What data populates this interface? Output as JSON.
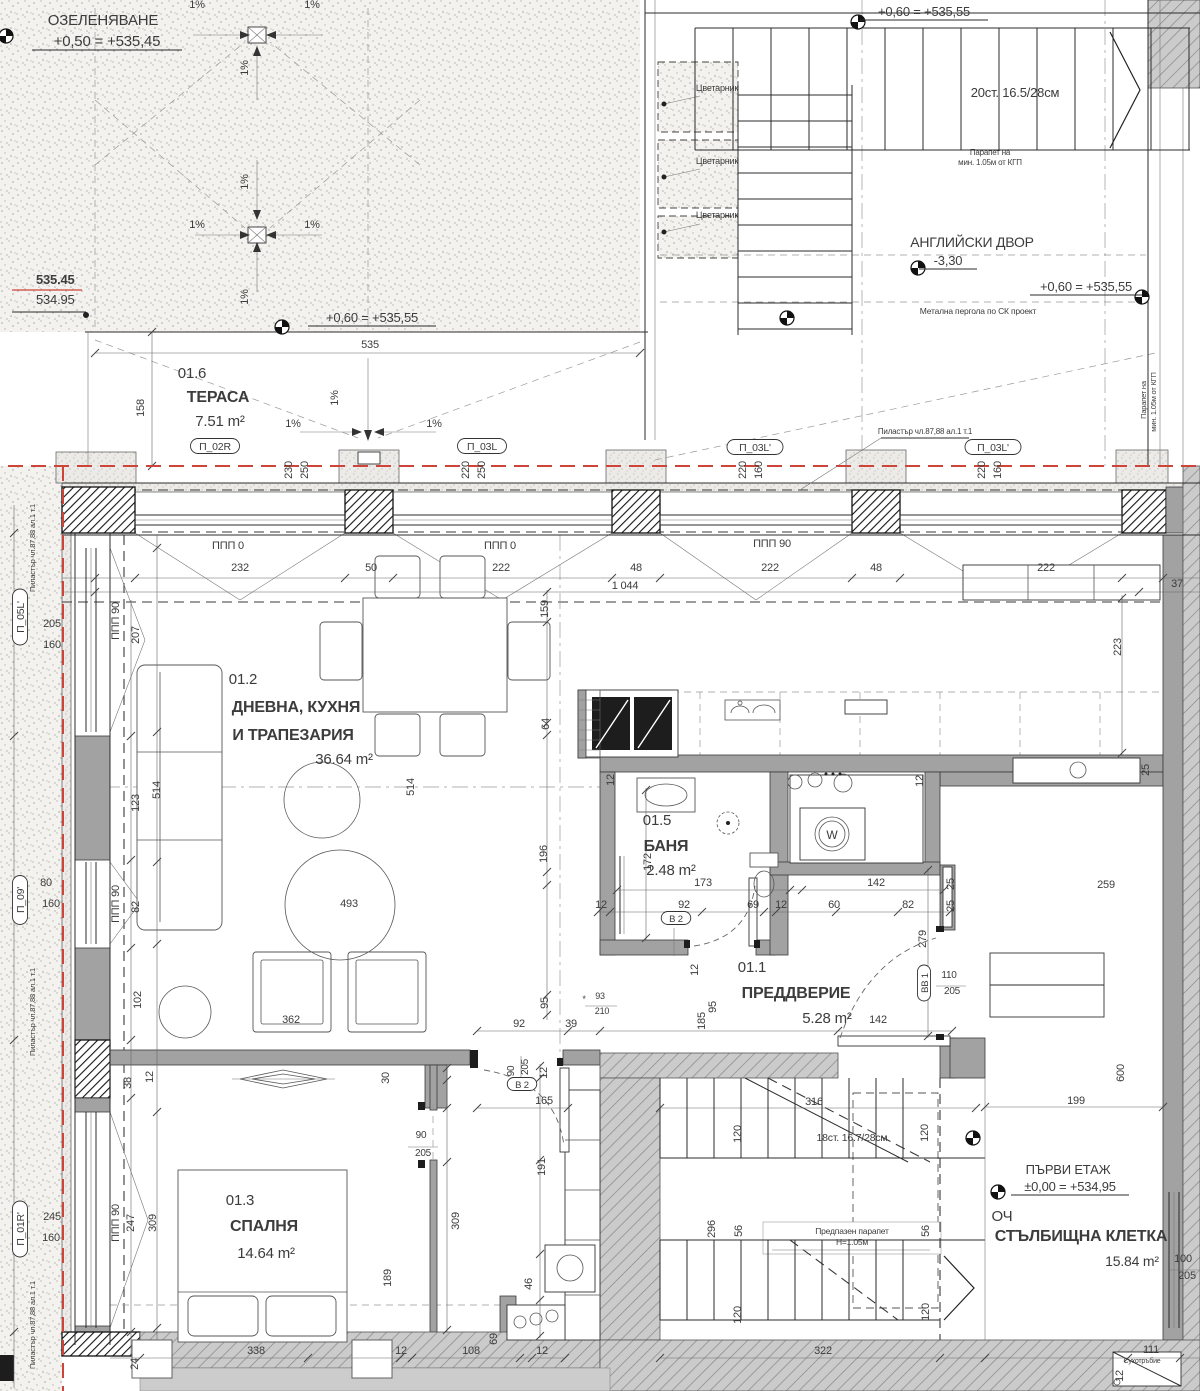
{
  "site": {
    "landscaping_title": "ОЗЕЛЕНЯВАНЕ",
    "landscaping_level": "+0,50 = +535,45",
    "spot_level_red": "535.45",
    "spot_level_black": "534.95",
    "court_name": "АНГЛИЙСКИ ДВОР",
    "court_level": "-3,30",
    "upper_level": "+0,60 = +535,55",
    "slope": "1%"
  },
  "apartment_tag": {
    "id": "АП.01",
    "area": "83.61 m²"
  },
  "stairwell": {
    "floor_title": "ПЪРВИ ЕТАЖ",
    "floor_level": "±0,00 = +534,95",
    "och": "ОЧ",
    "name": "СТЪЛБИЩНА КЛЕТКА",
    "area": "15.84 m²",
    "inner_stair": "18ст. 16.7/28см",
    "outer_stair": "20ст. 16.5/28см",
    "guard": [
      "Предпазен парапет",
      "Н=1.05м"
    ],
    "dry_riser": "Сухотръбие"
  },
  "rooms": [
    {
      "number": "01.6",
      "name": [
        "ТЕРАСА"
      ],
      "area": "7.51 m²",
      "np": [
        192,
        378
      ],
      "lp": [
        [
          218,
          402
        ]
      ],
      "ap": [
        220,
        426
      ]
    },
    {
      "number": "01.2",
      "name": [
        "ДНЕВНА, КУХНЯ",
        "И ТРАПЕЗАРИЯ"
      ],
      "area": "36.64 m²",
      "np": [
        243,
        684
      ],
      "lp": [
        [
          296,
          712
        ],
        [
          293,
          740
        ]
      ],
      "ap": [
        344,
        764
      ]
    },
    {
      "number": "01.5",
      "name": [
        "БАНЯ"
      ],
      "area": "2.48 m²",
      "np": [
        657,
        825
      ],
      "lp": [
        [
          666,
          851
        ]
      ],
      "ap": [
        671,
        875
      ]
    },
    {
      "number": "01.1",
      "name": [
        "ПРЕДДВЕРИЕ"
      ],
      "area": "5.28 m²",
      "np": [
        752,
        972
      ],
      "lp": [
        [
          796,
          998
        ]
      ],
      "ap": [
        827,
        1023
      ]
    },
    {
      "number": "01.3",
      "name": [
        "СПАЛНЯ"
      ],
      "area": "14.64 m²",
      "np": [
        240,
        1205
      ],
      "lp": [
        [
          264,
          1231
        ]
      ],
      "ap": [
        266,
        1258
      ]
    }
  ],
  "window_tags": [
    {
      "label": "П_02R",
      "x": 215,
      "y": 449,
      "vertical": false
    },
    {
      "label": "П_03L",
      "x": 482,
      "y": 449,
      "vertical": false
    },
    {
      "label": "П_03L'",
      "x": 755,
      "y": 450,
      "vertical": false
    },
    {
      "label": "П_03L'",
      "x": 993,
      "y": 450,
      "vertical": false
    },
    {
      "label": "П_05L'",
      "x": 23,
      "y": 617,
      "vertical": true
    },
    {
      "label": "П_09'",
      "x": 23,
      "y": 900,
      "vertical": true
    },
    {
      "label": "П_01R'",
      "x": 23,
      "y": 1229,
      "vertical": true
    }
  ],
  "door_tags": [
    {
      "label": "В 2",
      "x": 676,
      "y": 921,
      "vertical": false
    },
    {
      "label": "В 2",
      "x": 522,
      "y": 1087,
      "vertical": false
    },
    {
      "label": "ВВ 1",
      "x": 927,
      "y": 983,
      "vertical": true
    }
  ],
  "annotations": [
    {
      "t": "ОЗЕЛЕНЯВАНЕ",
      "x": 103,
      "y": 25,
      "s": 15
    },
    {
      "t": "+0,50 = +535,45",
      "x": 107,
      "y": 46,
      "s": 15,
      "u": 150
    },
    {
      "t": "535.45",
      "x": 36,
      "y": 284,
      "s": 13,
      "b": 1,
      "c": "#cd4438",
      "a": "start"
    },
    {
      "t": "534.95",
      "x": 36,
      "y": 304,
      "s": 13,
      "a": "start"
    },
    {
      "t": "+0,60 = +535,55",
      "x": 924,
      "y": 16,
      "s": 13,
      "u": 128
    },
    {
      "t": "+0,60 = +535,55",
      "x": 372,
      "y": 322,
      "s": 13,
      "u": 128
    },
    {
      "t": "+0,60 = +535,55",
      "x": 1086,
      "y": 291,
      "s": 13,
      "u": 112
    },
    {
      "t": "20ст. 16.5/28см",
      "x": 1015,
      "y": 97,
      "s": 13
    },
    {
      "t": "Парапет на",
      "x": 990,
      "y": 155,
      "s": 8
    },
    {
      "t": "мин. 1.05м от КГП",
      "x": 990,
      "y": 165,
      "s": 8
    },
    {
      "t": "АНГЛИЙСКИ ДВОР",
      "x": 972,
      "y": 247,
      "s": 14
    },
    {
      "t": "-3,30",
      "x": 948,
      "y": 265,
      "s": 13,
      "u": 58
    },
    {
      "t": "Метална пергола по СК проект",
      "x": 978,
      "y": 314,
      "s": 8.5
    },
    {
      "t": "Цветарник",
      "x": 717,
      "y": 91,
      "s": 9
    },
    {
      "t": "Цветарник",
      "x": 717,
      "y": 164,
      "s": 9
    },
    {
      "t": "Цветарник",
      "x": 717,
      "y": 218,
      "s": 9
    },
    {
      "t": "Пиластър чл.87,88 ал.1 т.1",
      "x": 925,
      "y": 434,
      "s": 8,
      "u": 88
    },
    {
      "t": "Пиластър чл.87,88 ал.1 т.1",
      "x": 35,
      "y": 548,
      "s": 7.5,
      "r": 1
    },
    {
      "t": "Пиластър чл.87,88 ал.1 т.1",
      "x": 35,
      "y": 1012,
      "s": 7.5,
      "r": 1
    },
    {
      "t": "Пиластър чл.87,88 ал.1 т.1",
      "x": 35,
      "y": 1325,
      "s": 7.5,
      "r": 1
    },
    {
      "t": "Парапет на",
      "x": 1146,
      "y": 400,
      "s": 7.5,
      "r": 1
    },
    {
      "t": "мин. 1.05м от КГП",
      "x": 1156,
      "y": 402,
      "s": 7.5,
      "r": 1
    },
    {
      "t": "ППП 0",
      "x": 228,
      "y": 549,
      "s": 11
    },
    {
      "t": "ППП 0",
      "x": 500,
      "y": 549,
      "s": 11
    },
    {
      "t": "ППП 90",
      "x": 772,
      "y": 547,
      "s": 11
    },
    {
      "t": "ППП 90",
      "x": 119,
      "y": 621,
      "s": 11,
      "r": 1
    },
    {
      "t": "ППП 90",
      "x": 119,
      "y": 904,
      "s": 11,
      "r": 1
    },
    {
      "t": "ППП 90",
      "x": 119,
      "y": 1223,
      "s": 11,
      "r": 1
    },
    {
      "t": "Предпазен парапет",
      "x": 852,
      "y": 1234,
      "s": 8.5
    },
    {
      "t": "Н=1.05м",
      "x": 852,
      "y": 1245,
      "s": 8.5
    },
    {
      "t": "18ст. 16.7/28см",
      "x": 852,
      "y": 1141,
      "s": 10.5
    },
    {
      "t": "Сухотръбие",
      "x": 1142,
      "y": 1363,
      "s": 7
    },
    {
      "t": "ПЪРВИ ЕТАЖ",
      "x": 1068,
      "y": 1174,
      "s": 13
    },
    {
      "t": "±0,00 = +534,95",
      "x": 1070,
      "y": 1191,
      "s": 13,
      "u": 118
    },
    {
      "t": "ОЧ",
      "x": 1002,
      "y": 1221,
      "s": 15
    },
    {
      "t": "СТЪЛБИЩНА КЛЕТКА",
      "x": 1081,
      "y": 1241,
      "s": 16,
      "b": 1
    },
    {
      "t": "15.84 m²",
      "x": 1132,
      "y": 1266,
      "s": 14
    },
    {
      "t": "W",
      "x": 832,
      "y": 839,
      "s": 12
    }
  ],
  "dimensions": [
    [
      "535",
      370,
      348
    ],
    [
      "232",
      240,
      571
    ],
    [
      "50",
      371,
      571
    ],
    [
      "222",
      501,
      571
    ],
    [
      "48",
      636,
      571
    ],
    [
      "222",
      770,
      571
    ],
    [
      "48",
      876,
      571
    ],
    [
      "222",
      1046,
      571
    ],
    [
      "1 044",
      625,
      589
    ],
    [
      "37",
      1177,
      587
    ],
    [
      "158",
      144,
      408,
      1
    ],
    [
      "1%",
      338,
      398,
      1
    ],
    [
      "1%",
      293,
      427
    ],
    [
      "1%",
      434,
      427
    ],
    [
      "1%",
      248,
      68,
      1
    ],
    [
      "1%",
      248,
      182,
      1
    ],
    [
      "1%",
      197,
      228
    ],
    [
      "1%",
      312,
      228
    ],
    [
      "1%",
      248,
      297,
      1
    ],
    [
      "1%",
      197,
      8
    ],
    [
      "1%",
      312,
      8
    ],
    [
      "230",
      292,
      470,
      1
    ],
    [
      "250",
      308,
      470,
      1
    ],
    [
      "220",
      469,
      470,
      1
    ],
    [
      "250",
      485,
      470,
      1
    ],
    [
      "220",
      746,
      470,
      1
    ],
    [
      "160",
      762,
      470,
      1
    ],
    [
      "220",
      985,
      470,
      1
    ],
    [
      "160",
      1001,
      470,
      1
    ],
    [
      "205",
      52,
      627
    ],
    [
      "160",
      52,
      648
    ],
    [
      "80",
      46,
      886
    ],
    [
      "160",
      51,
      907
    ],
    [
      "245",
      52,
      1220
    ],
    [
      "160",
      51,
      1241
    ],
    [
      "207",
      139,
      635,
      1
    ],
    [
      "514",
      160,
      790,
      1
    ],
    [
      "123",
      139,
      803,
      1
    ],
    [
      "82",
      139,
      907,
      1
    ],
    [
      "102",
      141,
      1000,
      1
    ],
    [
      "38",
      131,
      1083,
      1
    ],
    [
      "12",
      153,
      1077,
      1
    ],
    [
      "514",
      414,
      787,
      1
    ],
    [
      "493",
      349,
      907
    ],
    [
      "362",
      291,
      1023
    ],
    [
      "159",
      548,
      609,
      1
    ],
    [
      "64",
      549,
      724,
      1
    ],
    [
      "196",
      547,
      854,
      1
    ],
    [
      "95",
      548,
      1003,
      1
    ],
    [
      "92",
      519,
      1027
    ],
    [
      "39",
      571,
      1027
    ],
    [
      "93",
      600,
      999,
      0,
      9
    ],
    [
      "210",
      602,
      1014,
      0,
      9
    ],
    [
      "*",
      584,
      1002,
      0,
      9
    ],
    [
      "185",
      705,
      1021,
      1
    ],
    [
      "95",
      716,
      1007,
      1
    ],
    [
      "223",
      1121,
      647,
      1
    ],
    [
      "25",
      1149,
      770,
      1
    ],
    [
      "259",
      1106,
      888
    ],
    [
      "12",
      614,
      780,
      1
    ],
    [
      "172",
      651,
      862,
      1
    ],
    [
      "173",
      703,
      886
    ],
    [
      "142",
      876,
      886
    ],
    [
      "12",
      601,
      908
    ],
    [
      "92",
      684,
      908
    ],
    [
      "69",
      753,
      908
    ],
    [
      "12",
      781,
      908
    ],
    [
      "60",
      834,
      908
    ],
    [
      "82",
      908,
      908
    ],
    [
      "25",
      954,
      884,
      1
    ],
    [
      "25",
      954,
      906,
      1
    ],
    [
      "12",
      923,
      781,
      1
    ],
    [
      "279",
      926,
      939,
      1
    ],
    [
      "142",
      878,
      1023
    ],
    [
      "110",
      949,
      978,
      0,
      10
    ],
    [
      "205",
      952,
      994,
      0,
      10
    ],
    [
      "12",
      698,
      970,
      1
    ],
    [
      "247",
      134,
      1223,
      1
    ],
    [
      "309",
      156,
      1223,
      1
    ],
    [
      "30",
      389,
      1078,
      1
    ],
    [
      "189",
      391,
      1278,
      1
    ],
    [
      "338",
      256,
      1354
    ],
    [
      "12",
      401,
      1354
    ],
    [
      "108",
      471,
      1354
    ],
    [
      "12",
      542,
      1354
    ],
    [
      "69",
      497,
      1339,
      1
    ],
    [
      "24",
      138,
      1364,
      1
    ],
    [
      "90",
      421,
      1138,
      0,
      10
    ],
    [
      "205",
      423,
      1156,
      0,
      10
    ],
    [
      "90",
      514,
      1071,
      1,
      10
    ],
    [
      "205",
      528,
      1067,
      1,
      10
    ],
    [
      "12",
      547,
      1073,
      1
    ],
    [
      "165",
      544,
      1104
    ],
    [
      "191",
      545,
      1167,
      1
    ],
    [
      "309",
      459,
      1221,
      1
    ],
    [
      "46",
      532,
      1284,
      1
    ],
    [
      "316",
      814,
      1105
    ],
    [
      "120",
      741,
      1134,
      1
    ],
    [
      "120",
      928,
      1133,
      1
    ],
    [
      "296",
      715,
      1229,
      1
    ],
    [
      "56",
      742,
      1231,
      1
    ],
    [
      "56",
      929,
      1231,
      1
    ],
    [
      "120",
      741,
      1315,
      1
    ],
    [
      "120",
      929,
      1312,
      1
    ],
    [
      "322",
      823,
      1354
    ],
    [
      "199",
      1076,
      1104
    ],
    [
      "600",
      1124,
      1073,
      1
    ],
    [
      "111",
      1151,
      1353
    ],
    [
      "12",
      1123,
      1376,
      1
    ],
    [
      "100",
      1183,
      1262
    ],
    [
      "205",
      1187,
      1279
    ]
  ]
}
